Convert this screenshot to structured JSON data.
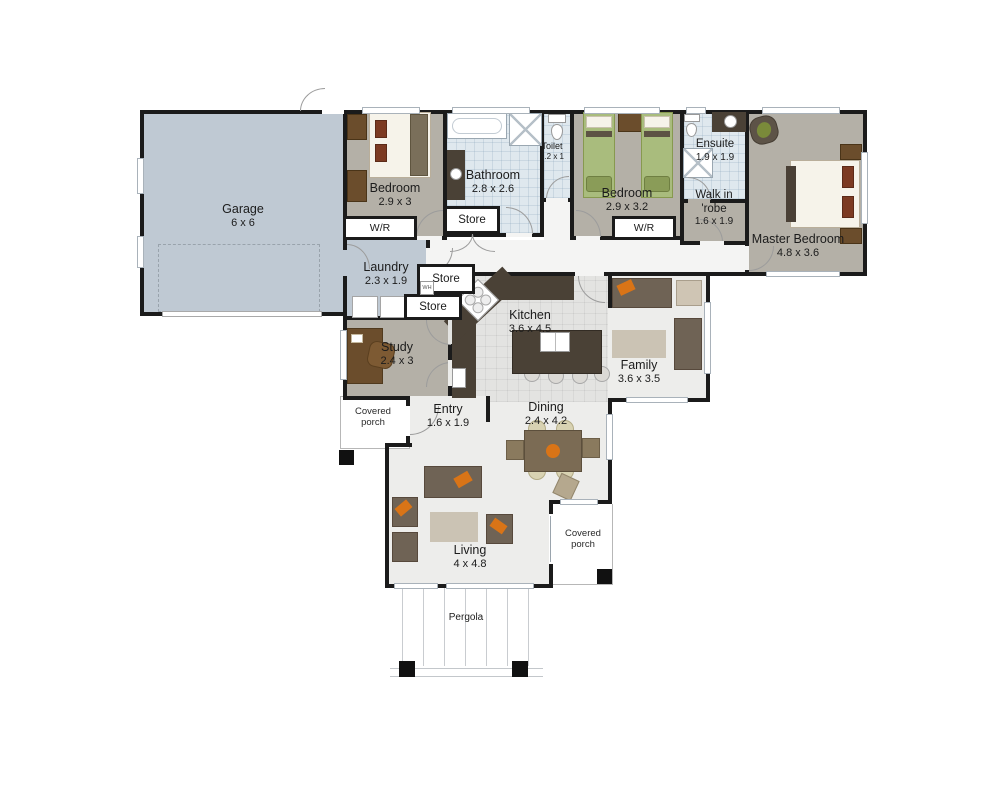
{
  "plan": {
    "rooms": {
      "garage": {
        "name": "Garage",
        "dims": "6 x 6"
      },
      "bedroom1": {
        "name": "Bedroom",
        "dims": "2.9 x 3"
      },
      "bathroom": {
        "name": "Bathroom",
        "dims": "2.8 x 2.6"
      },
      "toilet": {
        "name": "Toilet",
        "dims": "2.2 x 1"
      },
      "bedroom2": {
        "name": "Bedroom",
        "dims": "2.9 x 3.2"
      },
      "ensuite": {
        "name": "Ensuite",
        "dims": "1.9 x 1.9"
      },
      "walk_in_robe": {
        "line1": "Walk in",
        "line2": "'robe",
        "dims": "1.6 x 1.9"
      },
      "master_bedroom": {
        "name": "Master Bedroom",
        "dims": "4.8 x 3.6"
      },
      "laundry": {
        "name": "Laundry",
        "dims": "2.3 x 1.9"
      },
      "study": {
        "name": "Study",
        "dims": "2.4 x 3"
      },
      "kitchen": {
        "name": "Kitchen",
        "dims": "3.6 x 4.5"
      },
      "family": {
        "name": "Family",
        "dims": "3.6 x 3.5"
      },
      "entry": {
        "name": "Entry",
        "dims": "1.6 x 1.9"
      },
      "dining": {
        "name": "Dining",
        "dims": "2.4 x 4.2"
      },
      "living": {
        "name": "Living",
        "dims": "4 x 4.8"
      }
    },
    "storage": {
      "wr1": "W/R",
      "wr2": "W/R",
      "store_bath": "Store",
      "store_hall_upper": "Store",
      "store_hall_lower": "Store",
      "water_heater": "WH"
    },
    "outdoor": {
      "porch_left_line1": "Covered",
      "porch_left_line2": "porch",
      "porch_right_line1": "Covered",
      "porch_right_line2": "porch",
      "pergola": "Pergola"
    }
  },
  "colors": {
    "wall": "#1b1b1b",
    "garage_floor": "#bfc9d3",
    "room_floor": "#b4b0a7",
    "tile_floor": "#dfe8ee",
    "kitchen_floor": "#e3e3e1",
    "living_floor": "#ededeb",
    "hall_floor": "#f4f4f3",
    "sofa_dark": "#6f6355",
    "wood_brown": "#6b4d2c",
    "counter_dark": "#4a4136",
    "accent_orange": "#d97417",
    "bed_green": "#a9bc7d",
    "rug_beige": "#cbc3b4",
    "chair_beige": "#cfc5b4"
  }
}
